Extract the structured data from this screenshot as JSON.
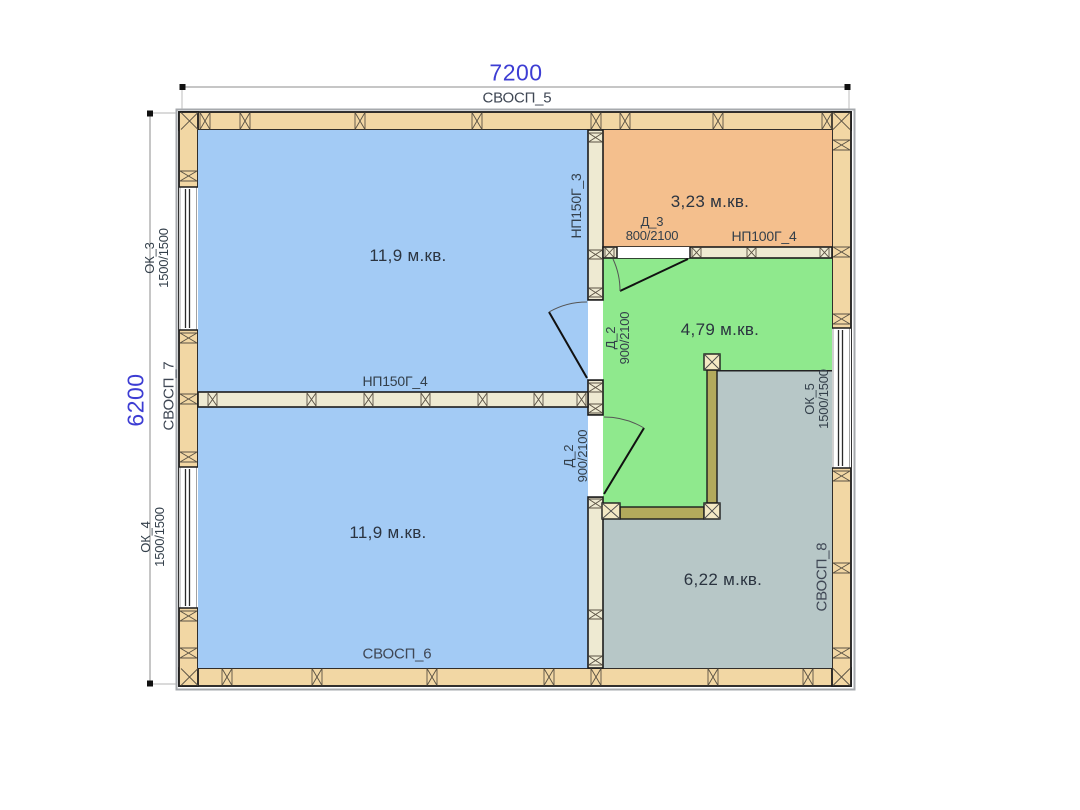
{
  "drawing": {
    "type": "floor-plan",
    "dimensions": {
      "width_mm": "7200",
      "height_mm": "6200"
    },
    "walls": {
      "top": {
        "label": "СВОСП_5"
      },
      "bottom": {
        "label": "СВОСП_6"
      },
      "left": {
        "label": "СВОСП_7"
      },
      "right": {
        "label": "СВОСП_8"
      },
      "partition_vertical": {
        "label": "НП150Г_3"
      },
      "partition_middle": {
        "label": "НП150Г_4"
      },
      "partition_storage": {
        "label": "НП100Г_4"
      }
    },
    "rooms": {
      "upper_left": {
        "area": "11,9 м.кв.",
        "fill": "#a3cbf5"
      },
      "lower_left": {
        "area": "11,9 м.кв.",
        "fill": "#a3cbf5"
      },
      "upper_right": {
        "area": "3,23 м.кв.",
        "fill": "#f4bf8d"
      },
      "hall": {
        "area": "4,79 м.кв.",
        "fill": "#8fe98d"
      },
      "lower_right": {
        "area": "6,22 м.кв.",
        "fill": "#b7c7c7"
      }
    },
    "windows": {
      "ok3": {
        "name": "ОК_3",
        "size": "1500/1500"
      },
      "ok4": {
        "name": "ОК_4",
        "size": "1500/1500"
      },
      "ok5": {
        "name": "ОК_5",
        "size": "1500/1500"
      }
    },
    "doors": {
      "d3": {
        "name": "Д_3",
        "size": "800/2100"
      },
      "d2_upper": {
        "name": "Д_2",
        "size": "900/2100"
      },
      "d2_lower": {
        "name": "Д_2",
        "size": "900/2100"
      }
    }
  }
}
